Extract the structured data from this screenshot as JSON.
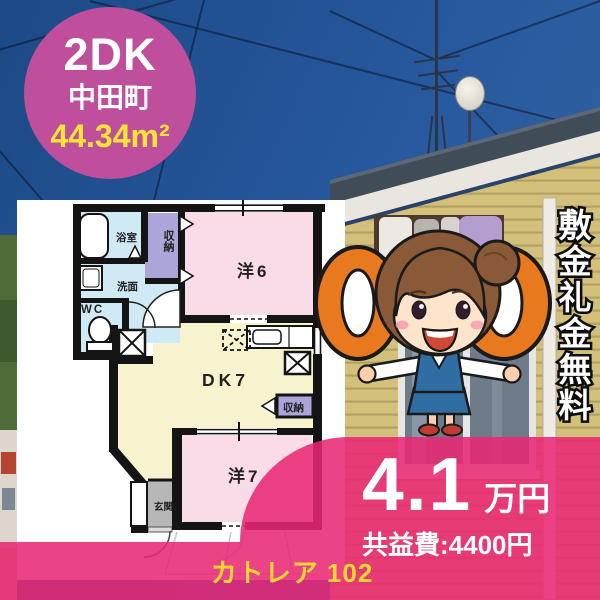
{
  "badge": {
    "layout_type": "2DK",
    "town": "中田町",
    "floor_area": "44.34m²"
  },
  "floorplan": {
    "rooms": {
      "bath": "浴室",
      "washroom": "洗面",
      "toilet": "WC",
      "closet_top": "収納",
      "western6": "洋6",
      "dining_kitchen": "DK7",
      "closet_right": "収納",
      "western7": "洋7",
      "entrance": "玄関"
    }
  },
  "side_banner": {
    "text": "敷金礼金無料"
  },
  "price": {
    "rent_value": "4.1",
    "rent_unit": "万円",
    "common_fee": "共益費:4400円"
  },
  "footer": {
    "property_name": "カトレア 102"
  },
  "colors": {
    "overlay_pink": "#e92774",
    "badge_pink": "#bf4f9d",
    "ring_orange": "#e8791e",
    "area_text_yellow": "#ffe636",
    "footer_text_yellow": "#ffd930",
    "room_pink": "#f9dce8",
    "room_cream": "#f8f3cf",
    "room_blue": "#cfe9f5",
    "closet_lavender": "#aba5da"
  }
}
